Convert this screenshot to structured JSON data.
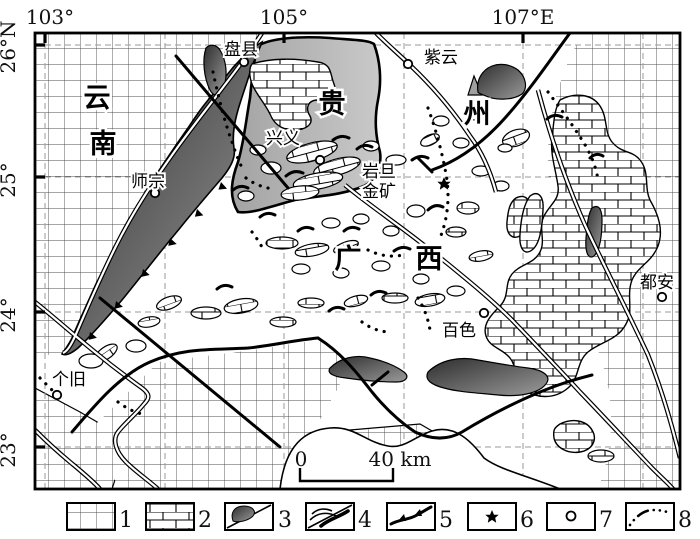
{
  "axes": {
    "top": [
      "103°",
      "105°",
      "107°E"
    ],
    "left": [
      "26°N",
      "25°",
      "24°",
      "23°"
    ]
  },
  "provinces": {
    "yun": "云",
    "nan": "南",
    "gui": "贵",
    "zhou": "州",
    "guang": "广",
    "xi": "西"
  },
  "cities": {
    "panxian": "盘县",
    "ziyun": "紫云",
    "xingyi": "兴义",
    "shizong": "师宗",
    "gejiu": "个旧",
    "baise": "百色",
    "duan": "都安"
  },
  "mine": {
    "line1": "岩旦",
    "line2": "金矿"
  },
  "scalebar": {
    "zero": "0",
    "forty": "40 km"
  },
  "legend": {
    "numbers": [
      "1",
      "2",
      "3",
      "4",
      "5",
      "6",
      "7",
      "8"
    ],
    "symbols": [
      "grid-unit",
      "limestone-brick-unit",
      "dark-igneous-body",
      "fold-lines",
      "thrust-fault",
      "gold-deposit-star",
      "city-circle",
      "dotted-boundary"
    ]
  },
  "colors": {
    "ink": "#111111",
    "graticule": "#9a9a9a",
    "dark_body_from": "#2e2e2e",
    "dark_body_to": "#9a9a9a",
    "gray_region_from": "#c9c9c9",
    "gray_region_to": "#a3a3a3"
  }
}
